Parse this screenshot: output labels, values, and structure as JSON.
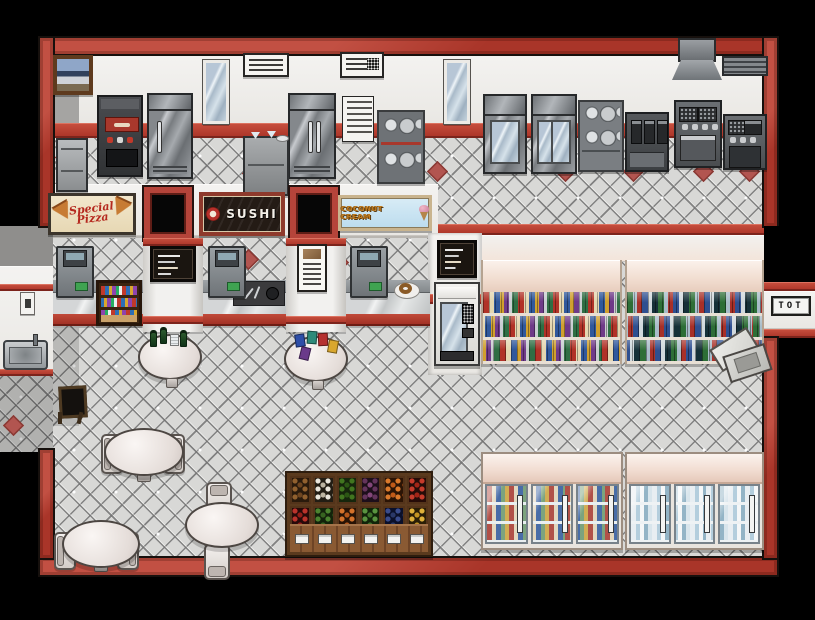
{
  "scene": {
    "name": "supermarket-food-court-tilemap"
  },
  "theme": {
    "wall_red": "#b5443a",
    "stripe_red": "#b23a2e",
    "wall_white": "#f1f0ee",
    "floor_gray": "#d8d8d6",
    "shelf_cream": "#f1ddd0",
    "outside_black": "#000000"
  },
  "signs": {
    "pizza": {
      "label": "Special Pizza"
    },
    "sushi": {
      "label": "SUSHI"
    },
    "ice_cream": {
      "label": "COCONUT CREAM"
    },
    "utensil": {
      "label": "TOT"
    }
  },
  "produce": {
    "bins": [
      {
        "name": "potatoes",
        "style": "background-color:#2a1a0c;background-image:radial-gradient(circle at 3px 3px,#91602e 2.3px,transparent 2.8px),radial-gradient(circle at 8px 7px,#6e4520 2.3px,transparent 2.8px);background-size:10px 8px,12px 10px"
      },
      {
        "name": "garlic",
        "style": "background-color:#221d14;background-image:radial-gradient(circle at 3px 3px,#eae6dc 2.3px,transparent 2.8px),radial-gradient(circle at 8px 7px,#bdb5a2 2.3px,transparent 2.8px);background-size:10px 8px,12px 10px"
      },
      {
        "name": "cucumbers",
        "style": "background-color:#16260c;background-image:radial-gradient(circle at 3px 3px,#41761f 2.3px,transparent 2.8px),radial-gradient(circle at 8px 7px,#2c5714 2.3px,transparent 2.8px);background-size:10px 8px,12px 10px"
      },
      {
        "name": "eggplants",
        "style": "background-color:#1d0f1b;background-image:radial-gradient(circle at 3px 3px,#64345c 2.3px,transparent 2.8px),radial-gradient(circle at 8px 7px,#83477a 2.3px,transparent 2.8px);background-size:10px 8px,12px 10px"
      },
      {
        "name": "oranges",
        "style": "background-color:#2b1405;background-image:radial-gradient(circle at 3px 3px,#db7a2c 2.3px,transparent 2.8px),radial-gradient(circle at 8px 7px,#c05a18 2.3px,transparent 2.8px);background-size:10px 8px,12px 10px"
      },
      {
        "name": "tomatoes",
        "style": "background-color:#260c08;background-image:radial-gradient(circle at 3px 3px,#c63b2b 2.3px,transparent 2.8px),radial-gradient(circle at 8px 7px,#a32517 2.3px,transparent 2.8px);background-size:10px 8px,12px 10px"
      },
      {
        "name": "apples",
        "style": "background-color:#280a09;background-image:radial-gradient(circle at 3px 3px,#bc332b 2.3px,transparent 2.8px),radial-gradient(circle at 8px 7px,#931f19 2.3px,transparent 2.8px);background-size:10px 8px,12px 10px"
      },
      {
        "name": "zucchini",
        "style": "background-color:#13230b;background-image:radial-gradient(circle at 3px 3px,#4c8430 2.3px,transparent 2.8px),radial-gradient(circle at 8px 7px,#376420 2.3px,transparent 2.8px);background-size:10px 8px,12px 10px"
      },
      {
        "name": "carrots",
        "style": "background-color:#281305;background-image:radial-gradient(circle at 3px 3px,#d4722a 2.3px,transparent 2.8px),radial-gradient(circle at 8px 7px,#b5571a 2.3px,transparent 2.8px);background-size:10px 8px,12px 10px"
      },
      {
        "name": "green-beans",
        "style": "background-color:#12240a;background-image:radial-gradient(circle at 3px 3px,#5a9440 2.3px,transparent 2.8px),radial-gradient(circle at 8px 7px,#40722a 2.3px,transparent 2.8px);background-size:10px 8px,12px 10px"
      },
      {
        "name": "blueberries",
        "style": "background-color:#0b102a;background-image:radial-gradient(circle at 3px 3px,#3a4c8c 2.3px,transparent 2.8px),radial-gradient(circle at 8px 7px,#2a3868 2.3px,transparent 2.8px);background-size:10px 8px,12px 10px"
      },
      {
        "name": "bananas",
        "style": "background-color:#2a1e06;background-image:radial-gradient(circle at 3px 3px,#e0b13a 2.3px,transparent 2.8px),radial-gradient(circle at 8px 7px,#c49422 2.3px,transparent 2.8px);background-size:10px 8px,12px 10px"
      }
    ]
  }
}
